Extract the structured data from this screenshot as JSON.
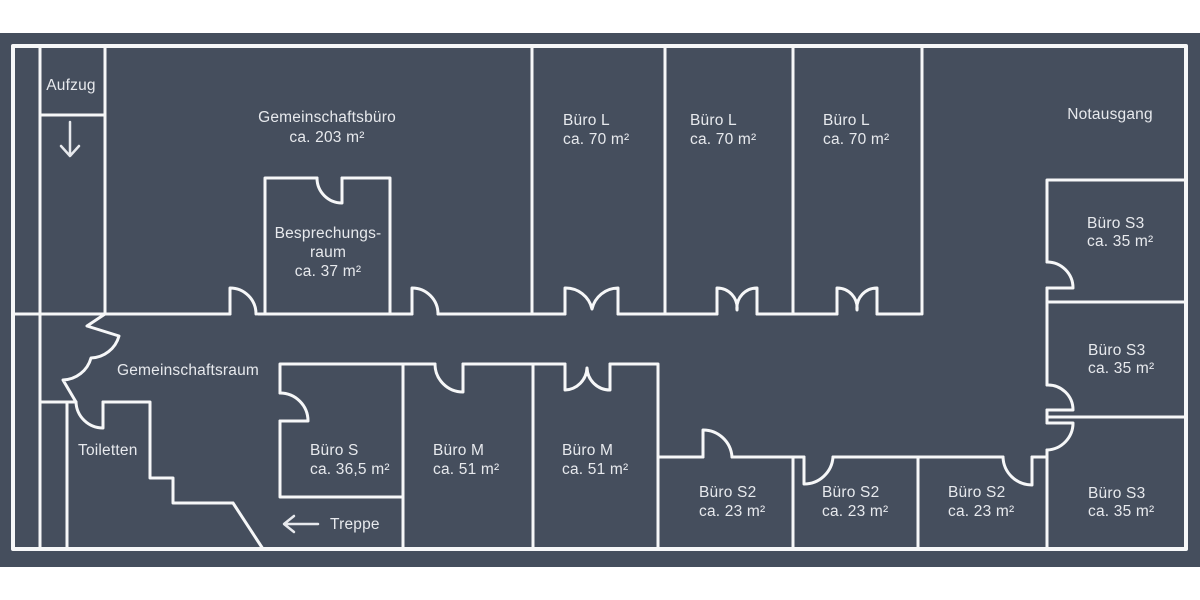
{
  "palette": {
    "page_background": "#ffffff",
    "plan_background": "#454e5d",
    "wall_color": "#f6f7f8",
    "text_color": "#e7e9ed"
  },
  "icons": {
    "aufzug_arrow": "down-arrow",
    "treppe_arrow": "left-arrow"
  },
  "rooms": {
    "aufzug": {
      "label": "Aufzug"
    },
    "gemeinschaftsbuero": {
      "label": "Gemeinschaftsbüro",
      "area": "ca. 203 m²"
    },
    "besprechungsraum": {
      "label_line1": "Besprechungs-",
      "label_line2": "raum",
      "area": "ca. 37 m²"
    },
    "buero_l": [
      {
        "label": "Büro L",
        "area": "ca. 70 m²"
      },
      {
        "label": "Büro L",
        "area": "ca. 70 m²"
      },
      {
        "label": "Büro L",
        "area": "ca. 70 m²"
      }
    ],
    "notausgang": {
      "label": "Notausgang"
    },
    "buero_s3": [
      {
        "label": "Büro S3",
        "area": "ca. 35 m²"
      },
      {
        "label": "Büro S3",
        "area": "ca. 35 m²"
      },
      {
        "label": "Büro S3",
        "area": "ca. 35 m²"
      }
    ],
    "gemeinschaftsraum": {
      "label": "Gemeinschaftsraum"
    },
    "toiletten": {
      "label": "Toiletten"
    },
    "buero_s": {
      "label": "Büro S",
      "area": "ca. 36,5 m²"
    },
    "buero_m": [
      {
        "label": "Büro M",
        "area": "ca. 51 m²"
      },
      {
        "label": "Büro M",
        "area": "ca. 51 m²"
      }
    ],
    "buero_s2": [
      {
        "label": "Büro S2",
        "area": "ca. 23 m²"
      },
      {
        "label": "Büro S2",
        "area": "ca. 23 m²"
      },
      {
        "label": "Büro S2",
        "area": "ca. 23 m²"
      }
    ],
    "treppe": {
      "label": "Treppe"
    }
  }
}
